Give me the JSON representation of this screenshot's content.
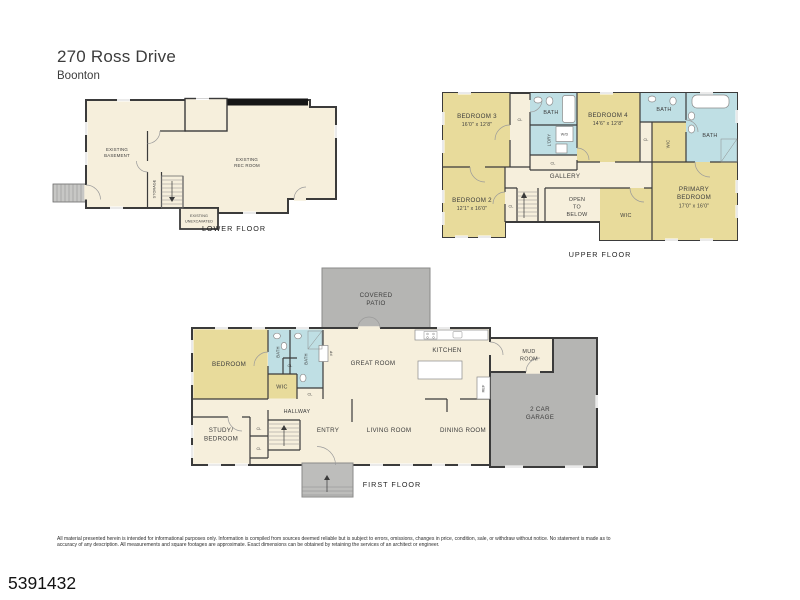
{
  "header": {
    "title": "270 Ross Drive",
    "subtitle": "Boonton"
  },
  "colors": {
    "room_yellow": "#e8db9b",
    "room_blue": "#bfdfe4",
    "floor_cream": "#f6efdc",
    "patio_gray": "#b5b5b3",
    "wall_dark": "#3b3b3b"
  },
  "floors": {
    "lower": {
      "caption": "LOWER FLOOR",
      "labels": {
        "basement_l1": "EXISTING",
        "basement_l2": "BASEMENT",
        "rec_l1": "EXISTING",
        "rec_l2": "REC ROOM",
        "storage": "STORAGE",
        "unexcavated_l1": "EXISTING",
        "unexcavated_l2": "UNEXCAVATED"
      }
    },
    "upper": {
      "caption": "UPPER FLOOR",
      "labels": {
        "bedroom3": "BEDROOM 3",
        "bedroom3_dim": "16'0\" x 12'8\"",
        "cl_bedroom3": "CL",
        "bath_hall": "BATH",
        "laundry": "L'DRY",
        "washer_dryer": "W/D",
        "cl_laundry": "CL",
        "bedroom4": "BEDROOM 4",
        "bedroom4_dim": "14'6\" x 12'8\"",
        "bath_small": "BATH",
        "bath_primary": "BATH",
        "wic_bath": "WIC",
        "cl_bedroom4": "CL",
        "gallery": "GALLERY",
        "bedroom2": "BEDROOM 2",
        "bedroom2_dim": "12'1\" x 16'0\"",
        "cl_bedroom2": "CL",
        "open_l1": "OPEN",
        "open_l2": "TO",
        "open_l3": "BELOW",
        "wic_primary": "WIC",
        "primary_l1": "PRIMARY",
        "primary_l2": "BEDROOM",
        "primary_dim": "17'0\" x 16'0\""
      }
    },
    "first": {
      "caption": "FIRST FLOOR",
      "labels": {
        "patio_l1": "COVERED",
        "patio_l2": "PATIO",
        "bedroom": "BEDROOM",
        "bath1": "BATH",
        "bath2": "BATH",
        "cl_bath1": "CL",
        "cl_bath2": "CL",
        "wic": "WIC",
        "fp": "FP",
        "great_room": "GREAT ROOM",
        "kitchen": "KITCHEN",
        "ref": "REF",
        "mud_l1": "MUD",
        "mud_l2": "ROOM",
        "garage_l1": "2 CAR",
        "garage_l2": "GARAGE",
        "hallway": "HALLWAY",
        "study_l1": "STUDY/",
        "study_l2": "BEDROOM",
        "cl_study1": "CL",
        "cl_study2": "CL",
        "entry": "ENTRY",
        "living_room": "LIVING ROOM",
        "dining_room": "DINING ROOM"
      }
    }
  },
  "footer": {
    "disclaimer_line1": "All material presented herein is intended for informational purposes only. Information is compiled from sources deemed reliable but is subject to errors, omissions, changes in price, condition, sale, or withdraw without notice. No statement is made as to",
    "disclaimer_line2": "accuracy of any description. All measurements and square footages are approximate. Exact dimensions can be obtained by retaining the services of an architect or engineer.",
    "mls_number": "5391432"
  }
}
